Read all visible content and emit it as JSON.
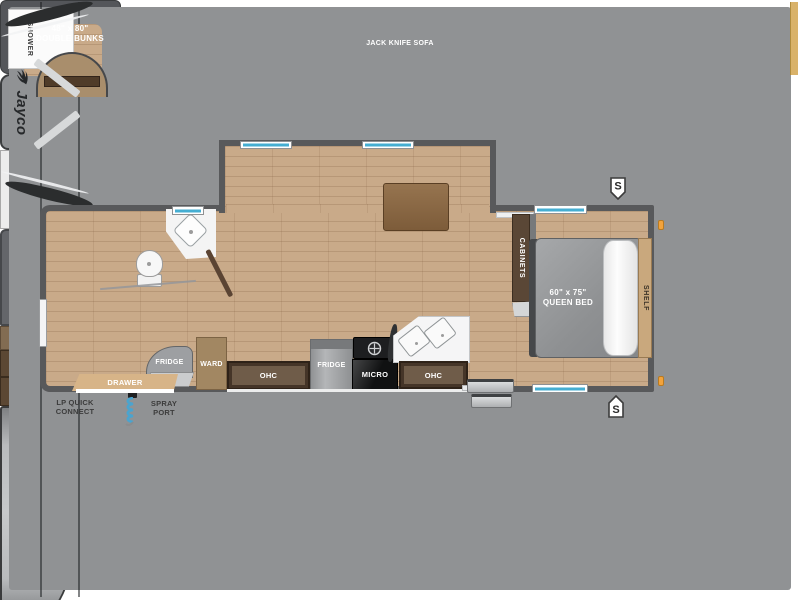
{
  "title": "284BHS",
  "brand": {
    "name": "Jayco"
  },
  "badges": {
    "speaker": "S"
  },
  "slide_out": {
    "sofa": "JACK KNIFE SOFA"
  },
  "bathroom": {
    "shower": "SHOWER"
  },
  "rear_section": {
    "bunks_size": "48\" x 80\"",
    "bunks_name": "DOUBLE BUNKS",
    "fridge": "FRIDGE",
    "drawer": "DRAWER",
    "ward": "WARD"
  },
  "kitchen": {
    "ent_center": "ENT. CENTER",
    "ohc_left": "OHC",
    "fridge": "FRIDGE",
    "micro": "MICRO",
    "ohc_right": "OHC",
    "cabinets": "CABINETS"
  },
  "bedroom": {
    "bed_size": "60\" x 75\"",
    "bed_name": "QUEEN BED",
    "ward_top": "WARD",
    "ward_bottom": "WARD",
    "shelf": "SHELF"
  },
  "exterior": {
    "awning": "16' AWNING",
    "lp_quick_connect_line1": "LP QUICK",
    "lp_quick_connect_line2": "CONNECT",
    "spray_port_line1": "SPRAY",
    "spray_port_line2": "PORT"
  },
  "colors": {
    "wall": "#58595b",
    "floor": "#c9aa89",
    "window_glass": "#45aed2",
    "front_cap": "#b9bbbd",
    "marker_light": "#f2a33c",
    "spray_coil": "#4aa4cf"
  }
}
